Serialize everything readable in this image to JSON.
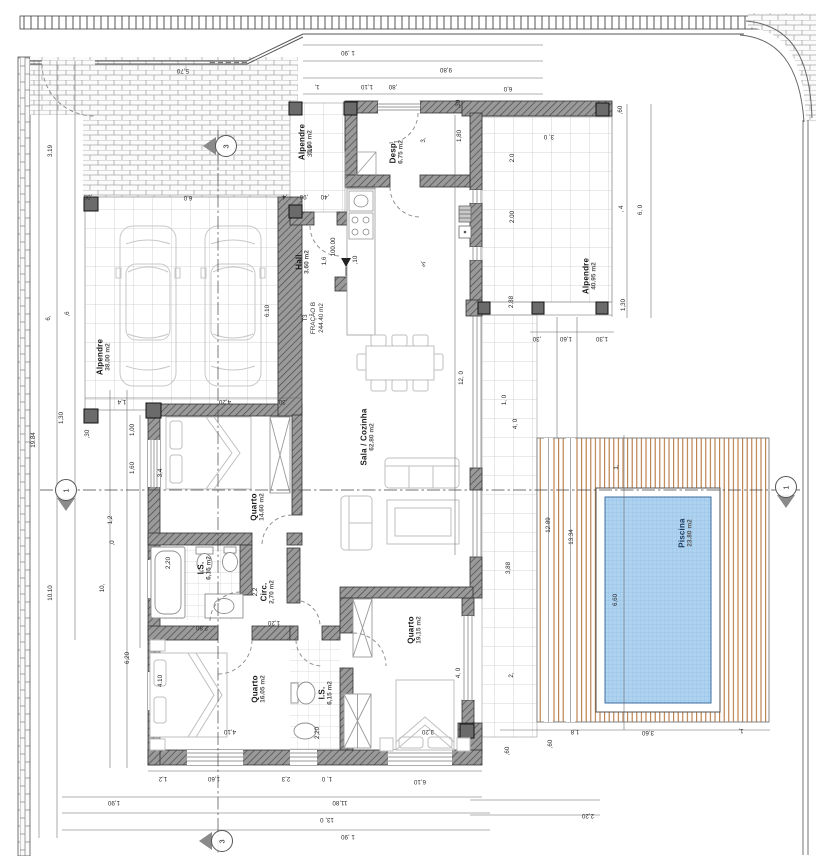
{
  "drawing": {
    "type": "floor-plan"
  },
  "unit_label": {
    "line1": "T3",
    "line2": "FRAÇÃO B",
    "line3": "244.40 m2",
    "x": 314,
    "y": 318
  },
  "colors": {
    "wall": "#9a9a9a",
    "hatch_line": "#4a4a4a",
    "water": "#aed2ef",
    "water_line": "#86b8e0",
    "deck_stripe": "#b26b2e",
    "pool_border": "#3c6f9f",
    "dim_text": "#2a2a2a",
    "label": "#1c1c1c"
  },
  "rooms": [
    {
      "id": "alpendre-garagem",
      "name": "Alpendre",
      "area": "38.00 m2",
      "x": 104,
      "y": 357
    },
    {
      "id": "alpendre-entrada",
      "name": "Alpendre",
      "area": "5.60 m2",
      "x": 306,
      "y": 142
    },
    {
      "id": "despensa",
      "name": "Desp.",
      "area": "6.75 m2",
      "x": 397,
      "y": 152
    },
    {
      "id": "hall",
      "name": "Hall",
      "area": "3.60 m2",
      "x": 303,
      "y": 262
    },
    {
      "id": "sala-cozinha",
      "name": "Sala / Cozinha",
      "area": "62.80 m2",
      "x": 368,
      "y": 437
    },
    {
      "id": "quarto-1",
      "name": "Quarto",
      "area": "14.60 m2",
      "x": 258,
      "y": 507
    },
    {
      "id": "is-1",
      "name": "I.S.",
      "area": "6,15 m2",
      "x": 205,
      "y": 568
    },
    {
      "id": "circ",
      "name": "Circ.",
      "area": "2,70 m2",
      "x": 268,
      "y": 592
    },
    {
      "id": "quarto-2",
      "name": "Quarto",
      "area": "16.05 m2",
      "x": 259,
      "y": 689
    },
    {
      "id": "is-2",
      "name": "I.S.",
      "area": "6,15 m2",
      "x": 326,
      "y": 693
    },
    {
      "id": "quarto-3",
      "name": "Quarto",
      "area": "19.15 m2",
      "x": 415,
      "y": 630
    },
    {
      "id": "alpendre-poente",
      "name": "Alpendre",
      "area": "40.95 m2",
      "x": 590,
      "y": 276
    },
    {
      "id": "piscina",
      "name": "Piscina",
      "area": "23.80 m2",
      "x": 686,
      "y": 533,
      "color": "#1d3a5f"
    }
  ],
  "dimensions": [
    {
      "t": "1 ,90",
      "x": 348,
      "y": 52,
      "r": 180
    },
    {
      "t": "9,80",
      "x": 446,
      "y": 69,
      "r": 180
    },
    {
      "t": "1,",
      "x": 317,
      "y": 86,
      "r": 180
    },
    {
      "t": "1,10",
      "x": 367,
      "y": 86,
      "r": 180
    },
    {
      "t": ",80",
      "x": 393,
      "y": 86,
      "r": 180
    },
    {
      "t": "6,0",
      "x": 508,
      "y": 88,
      "r": 180
    },
    {
      "t": "5,70",
      "x": 183,
      "y": 70,
      "r": 180
    },
    {
      "t": "6,0",
      "x": 188,
      "y": 197,
      "r": 180
    },
    {
      "t": ",30",
      "x": 88,
      "y": 196,
      "r": 180
    },
    {
      "t": "1,4",
      "x": 122,
      "y": 401,
      "r": 180
    },
    {
      "t": "4,20",
      "x": 225,
      "y": 401,
      "r": 180
    },
    {
      "t": ",30",
      "x": 283,
      "y": 401,
      "r": 180
    },
    {
      "t": "19.84",
      "x": 34,
      "y": 440,
      "r": 270
    },
    {
      "t": "3.19",
      "x": 51,
      "y": 151,
      "r": 270
    },
    {
      "t": "3.19",
      "x": 311,
      "y": 151,
      "r": 270
    },
    {
      "t": "6,",
      "x": 49,
      "y": 318,
      "r": 270
    },
    {
      "t": ",6",
      "x": 68,
      "y": 314,
      "r": 270
    },
    {
      "t": "10.10",
      "x": 51,
      "y": 593,
      "r": 270
    },
    {
      "t": "10,",
      "x": 103,
      "y": 588,
      "r": 270
    },
    {
      "t": "1,30",
      "x": 62,
      "y": 418,
      "r": 270
    },
    {
      "t": ",30",
      "x": 88,
      "y": 434,
      "r": 270
    },
    {
      "t": "1,00",
      "x": 133,
      "y": 430,
      "r": 270
    },
    {
      "t": "1,60",
      "x": 133,
      "y": 468,
      "r": 270
    },
    {
      "t": "1,2",
      "x": 111,
      "y": 520,
      "r": 270
    },
    {
      "t": ",0",
      "x": 113,
      "y": 543,
      "r": 270
    },
    {
      "t": "6,20",
      "x": 128,
      "y": 658,
      "r": 270
    },
    {
      "t": "3,4",
      "x": 161,
      "y": 473,
      "r": 270
    },
    {
      "t": "2,20",
      "x": 169,
      "y": 563,
      "r": 270
    },
    {
      "t": "2,2",
      "x": 256,
      "y": 592,
      "r": 270
    },
    {
      "t": "1,20",
      "x": 274,
      "y": 622,
      "r": 180
    },
    {
      "t": "2,80",
      "x": 202,
      "y": 627,
      "r": 180
    },
    {
      "t": "4.10",
      "x": 161,
      "y": 681,
      "r": 270
    },
    {
      "t": "4,10",
      "x": 230,
      "y": 731,
      "r": 180
    },
    {
      "t": "2,20",
      "x": 318,
      "y": 733,
      "r": 270
    },
    {
      "t": "1,6",
      "x": 325,
      "y": 261,
      "r": 270
    },
    {
      "t": ",10",
      "x": 356,
      "y": 260,
      "r": 270
    },
    {
      "t": ",4",
      "x": 285,
      "y": 196,
      "r": 180
    },
    {
      "t": ",90",
      "x": 304,
      "y": 196,
      "r": 180
    },
    {
      "t": ",40",
      "x": 325,
      "y": 196,
      "r": 180
    },
    {
      "t": "6.10",
      "x": 268,
      "y": 311,
      "r": 270
    },
    {
      "t": "3,",
      "x": 423,
      "y": 263,
      "r": 180
    },
    {
      "t": "3,",
      "x": 424,
      "y": 140,
      "r": 270
    },
    {
      "t": "3,20",
      "x": 428,
      "y": 731,
      "r": 180
    },
    {
      "t": "4, 0",
      "x": 459,
      "y": 673,
      "r": 270
    },
    {
      "t": "12, 0",
      "x": 462,
      "y": 378,
      "r": 270
    },
    {
      "t": ",60",
      "x": 621,
      "y": 110,
      "r": 270
    },
    {
      "t": "3, 0",
      "x": 549,
      "y": 136,
      "r": 180
    },
    {
      "t": "2.0",
      "x": 513,
      "y": 158,
      "r": 270
    },
    {
      "t": "2.00",
      "x": 513,
      "y": 217,
      "r": 270
    },
    {
      "t": "1,80",
      "x": 460,
      "y": 136,
      "r": 270
    },
    {
      "t": ",30",
      "x": 459,
      "y": 104,
      "r": 270
    },
    {
      "t": "2,88",
      "x": 512,
      "y": 302,
      "r": 270
    },
    {
      "t": ", 4",
      "x": 622,
      "y": 209,
      "r": 270
    },
    {
      "t": "6, 0",
      "x": 641,
      "y": 210,
      "r": 270
    },
    {
      "t": "1,30",
      "x": 624,
      "y": 305,
      "r": 270
    },
    {
      "t": ",30",
      "x": 537,
      "y": 338,
      "r": 180
    },
    {
      "t": "1,60",
      "x": 566,
      "y": 338,
      "r": 180
    },
    {
      "t": "1,30",
      "x": 602,
      "y": 338,
      "r": 180
    },
    {
      "t": "1, 0",
      "x": 505,
      "y": 400,
      "r": 270
    },
    {
      "t": "4, 0",
      "x": 516,
      "y": 424,
      "r": 270
    },
    {
      "t": "3,88",
      "x": 509,
      "y": 568,
      "r": 270
    },
    {
      "t": "2,",
      "x": 512,
      "y": 675,
      "r": 270
    },
    {
      "t": "12.89",
      "x": 549,
      "y": 525,
      "r": 270
    },
    {
      "t": "13.34",
      "x": 572,
      "y": 537,
      "r": 270
    },
    {
      "t": "6,60",
      "x": 616,
      "y": 600,
      "r": 270
    },
    {
      "t": "1,",
      "x": 617,
      "y": 467,
      "r": 270
    },
    {
      "t": "3,60",
      "x": 648,
      "y": 732,
      "r": 180
    },
    {
      "t": "1,8",
      "x": 575,
      "y": 731,
      "r": 180
    },
    {
      "t": "1,",
      "x": 741,
      "y": 730,
      "r": 180
    },
    {
      "t": ",60",
      "x": 508,
      "y": 751,
      "r": 270
    },
    {
      "t": ",60",
      "x": 551,
      "y": 744,
      "r": 270
    },
    {
      "t": "2,20",
      "x": 588,
      "y": 815,
      "r": 180
    },
    {
      "t": "1,2",
      "x": 163,
      "y": 778,
      "r": 180
    },
    {
      "t": "1,60",
      "x": 214,
      "y": 778,
      "r": 180
    },
    {
      "t": "2,3",
      "x": 286,
      "y": 778,
      "r": 180
    },
    {
      "t": "1, 0",
      "x": 327,
      "y": 778,
      "r": 180
    },
    {
      "t": "6,10",
      "x": 420,
      "y": 781,
      "r": 180
    },
    {
      "t": "1,90",
      "x": 114,
      "y": 802,
      "r": 180
    },
    {
      "t": "11,80",
      "x": 340,
      "y": 802,
      "r": 180
    },
    {
      "t": "13, 0",
      "x": 327,
      "y": 819,
      "r": 180
    },
    {
      "t": "1 ,90",
      "x": 348,
      "y": 836,
      "r": 180
    },
    {
      "t": "100.00",
      "x": 334,
      "y": 247,
      "r": 270
    }
  ],
  "section_markers": [
    {
      "label": "3",
      "x": 226,
      "y": 146,
      "dir": "left"
    },
    {
      "label": "1",
      "x": 66,
      "y": 490,
      "dir": "down"
    },
    {
      "label": "1",
      "x": 786,
      "y": 487,
      "dir": "down"
    },
    {
      "label": "3",
      "x": 222,
      "y": 841,
      "dir": "left"
    }
  ]
}
